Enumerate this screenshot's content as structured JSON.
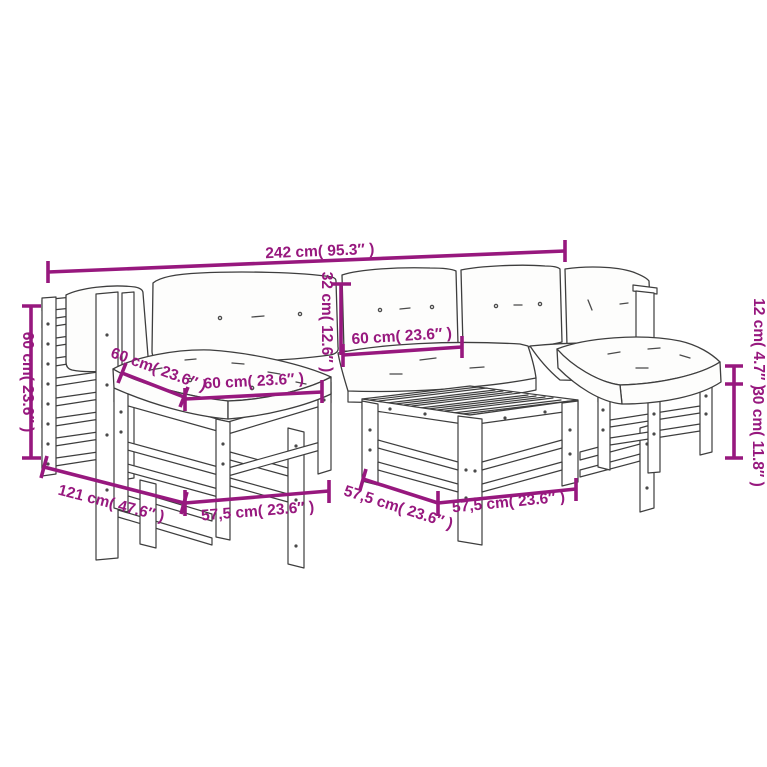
{
  "colors": {
    "dimension_accent": "#97187E",
    "line_art": "#3E3E3E",
    "background": "#FFFFFF"
  },
  "dimensions": {
    "overall_width": "242 cm( 95.3″ )",
    "side_height": "60 cm( 23.6″ )",
    "back_cushion_height": "32 cm( 12.6″ )",
    "seat_width_middle": "60 cm( 23.6″ )",
    "seat_depth_left": "60 cm( 23.6″ )",
    "seat_width_left": "60 cm( 23.6″ )",
    "corner_depth": "121 cm( 47.6″ )",
    "left_module_width": "57,5 cm( 23.6″ )",
    "table_depth": "57,5 cm( 23.6″ )",
    "table_width": "57,5 cm( 23.6″ )",
    "cushion_thickness": "12 cm( 4.7″ )",
    "stool_height": "30 cm( 11.8″ )"
  }
}
